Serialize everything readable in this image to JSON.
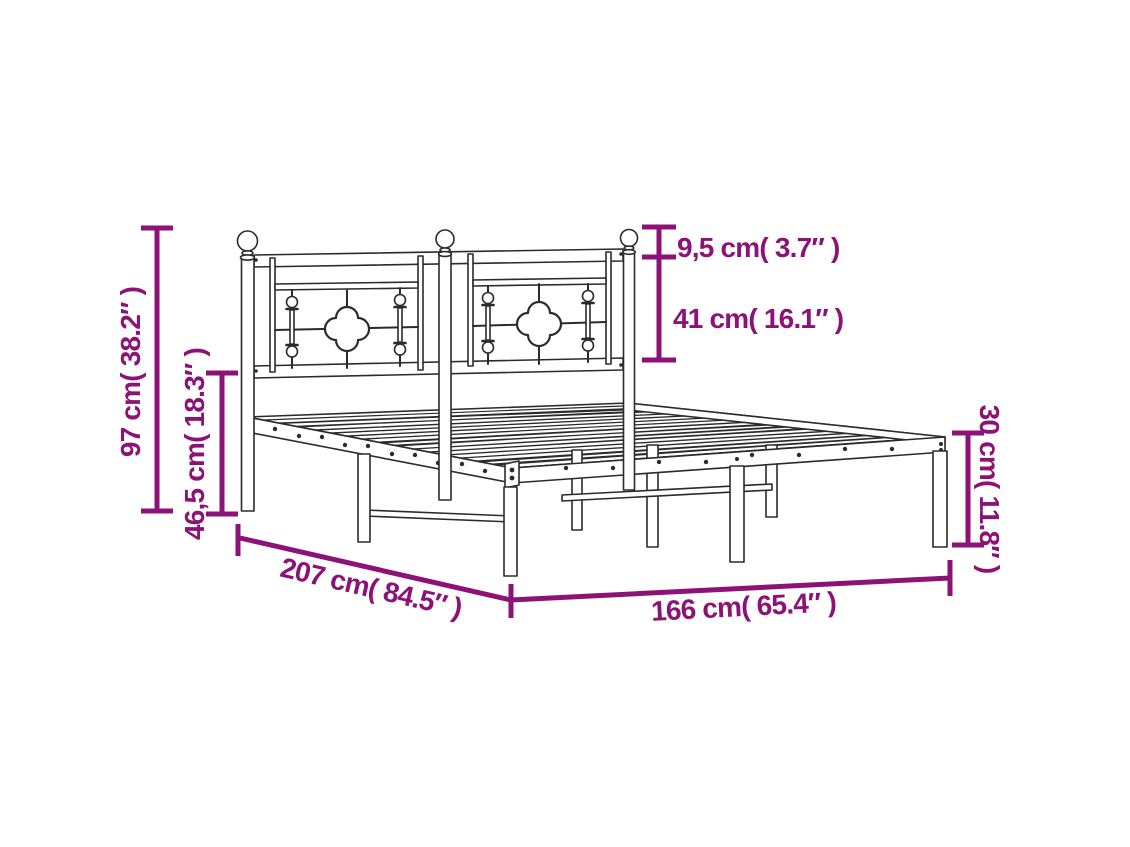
{
  "page": {
    "width": 1130,
    "height": 847,
    "background": "#ffffff"
  },
  "diagram": {
    "type": "product-dimension-diagram",
    "subject": "metal bed frame with decorative headboard",
    "colors": {
      "dimension": "#8C1277",
      "line": "#2B2B2B",
      "fill": "#FFFFFF"
    },
    "dimensions": {
      "overall_height": {
        "label": "97 cm( 38.2″ )",
        "cm": "97",
        "inches": "38.2"
      },
      "base_height": {
        "label": "46,5 cm( 18.3″ )",
        "cm": "46,5",
        "inches": "18.3"
      },
      "finial_height": {
        "label": "9,5 cm( 3.7″ )",
        "cm": "9,5",
        "inches": "3.7"
      },
      "headboard_panel_height": {
        "label": "41 cm( 16.1″ )",
        "cm": "41",
        "inches": "16.1"
      },
      "frame_height": {
        "label": "30 cm( 11.8″ )",
        "cm": "30",
        "inches": "11.8"
      },
      "length": {
        "label": "207 cm( 84.5″ )",
        "cm": "207",
        "inches": "84.5"
      },
      "width": {
        "label": "166 cm( 65.4″ )",
        "cm": "166",
        "inches": "65.4"
      }
    }
  }
}
